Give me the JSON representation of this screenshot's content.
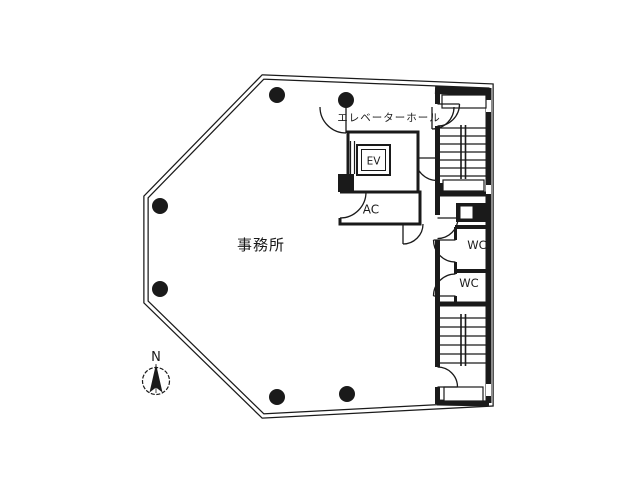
{
  "floorplan": {
    "colors": {
      "background": "#ffffff",
      "line": "#1a1a1a"
    },
    "rooms": {
      "office": {
        "label": "事務所"
      },
      "elevator_hall": {
        "label": "エレベーターホール"
      },
      "elevator": {
        "label": "EV"
      },
      "ac_room": {
        "label": "AC"
      },
      "wc_upper": {
        "label": "WC"
      },
      "wc_lower": {
        "label": "WC"
      }
    },
    "compass": {
      "north_label": "N"
    }
  }
}
